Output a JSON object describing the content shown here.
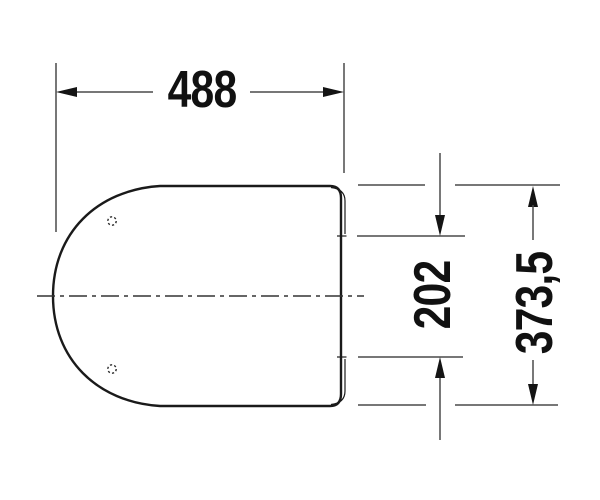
{
  "drawing": {
    "kind": "technical-dimension-drawing",
    "background_color": "#ffffff",
    "outline_color": "#1a1a1a",
    "dimension_line_color": "#4a4a4a",
    "text_color": "#111111",
    "dimensions": {
      "overall_width": {
        "label": "488"
      },
      "hinge_span": {
        "label": "202"
      },
      "overall_depth": {
        "label": "373,5"
      }
    }
  }
}
